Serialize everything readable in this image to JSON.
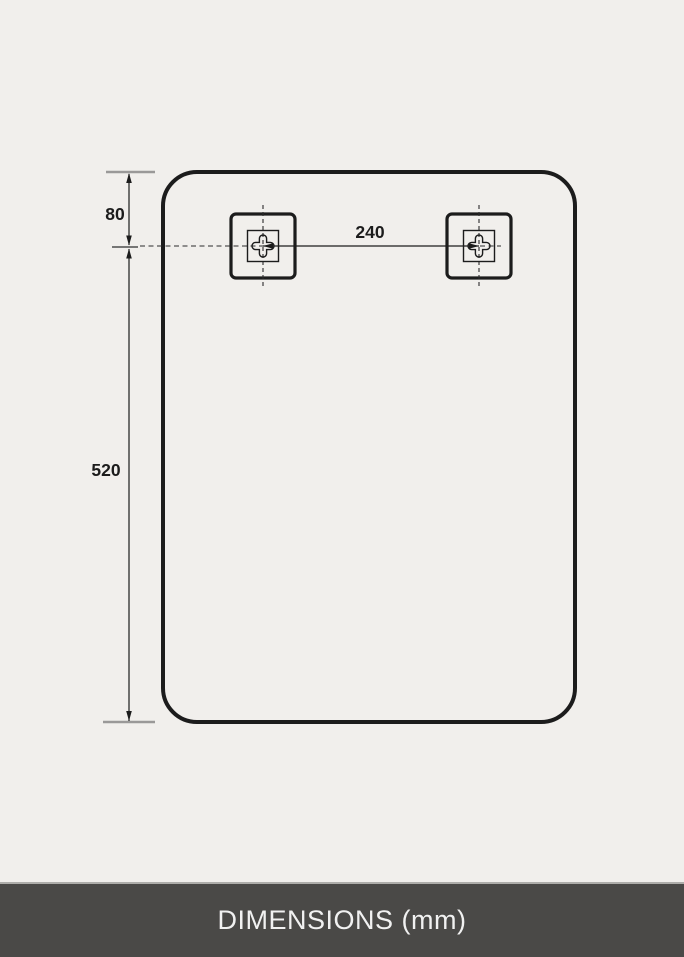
{
  "labels": {
    "dim_top": "80",
    "dim_bottom": "520",
    "dim_spacing": "240"
  },
  "footer": {
    "title": "DIMENSIONS (mm)"
  },
  "icons": {
    "bracket": "hanger-bracket-keyhole-cross"
  },
  "colors": {
    "background": "#f1efec",
    "line": "#1c1c1c",
    "extension_tick": "#9a9998",
    "footer_background": "#4a4947",
    "footer_text": "#f1f1f1"
  }
}
